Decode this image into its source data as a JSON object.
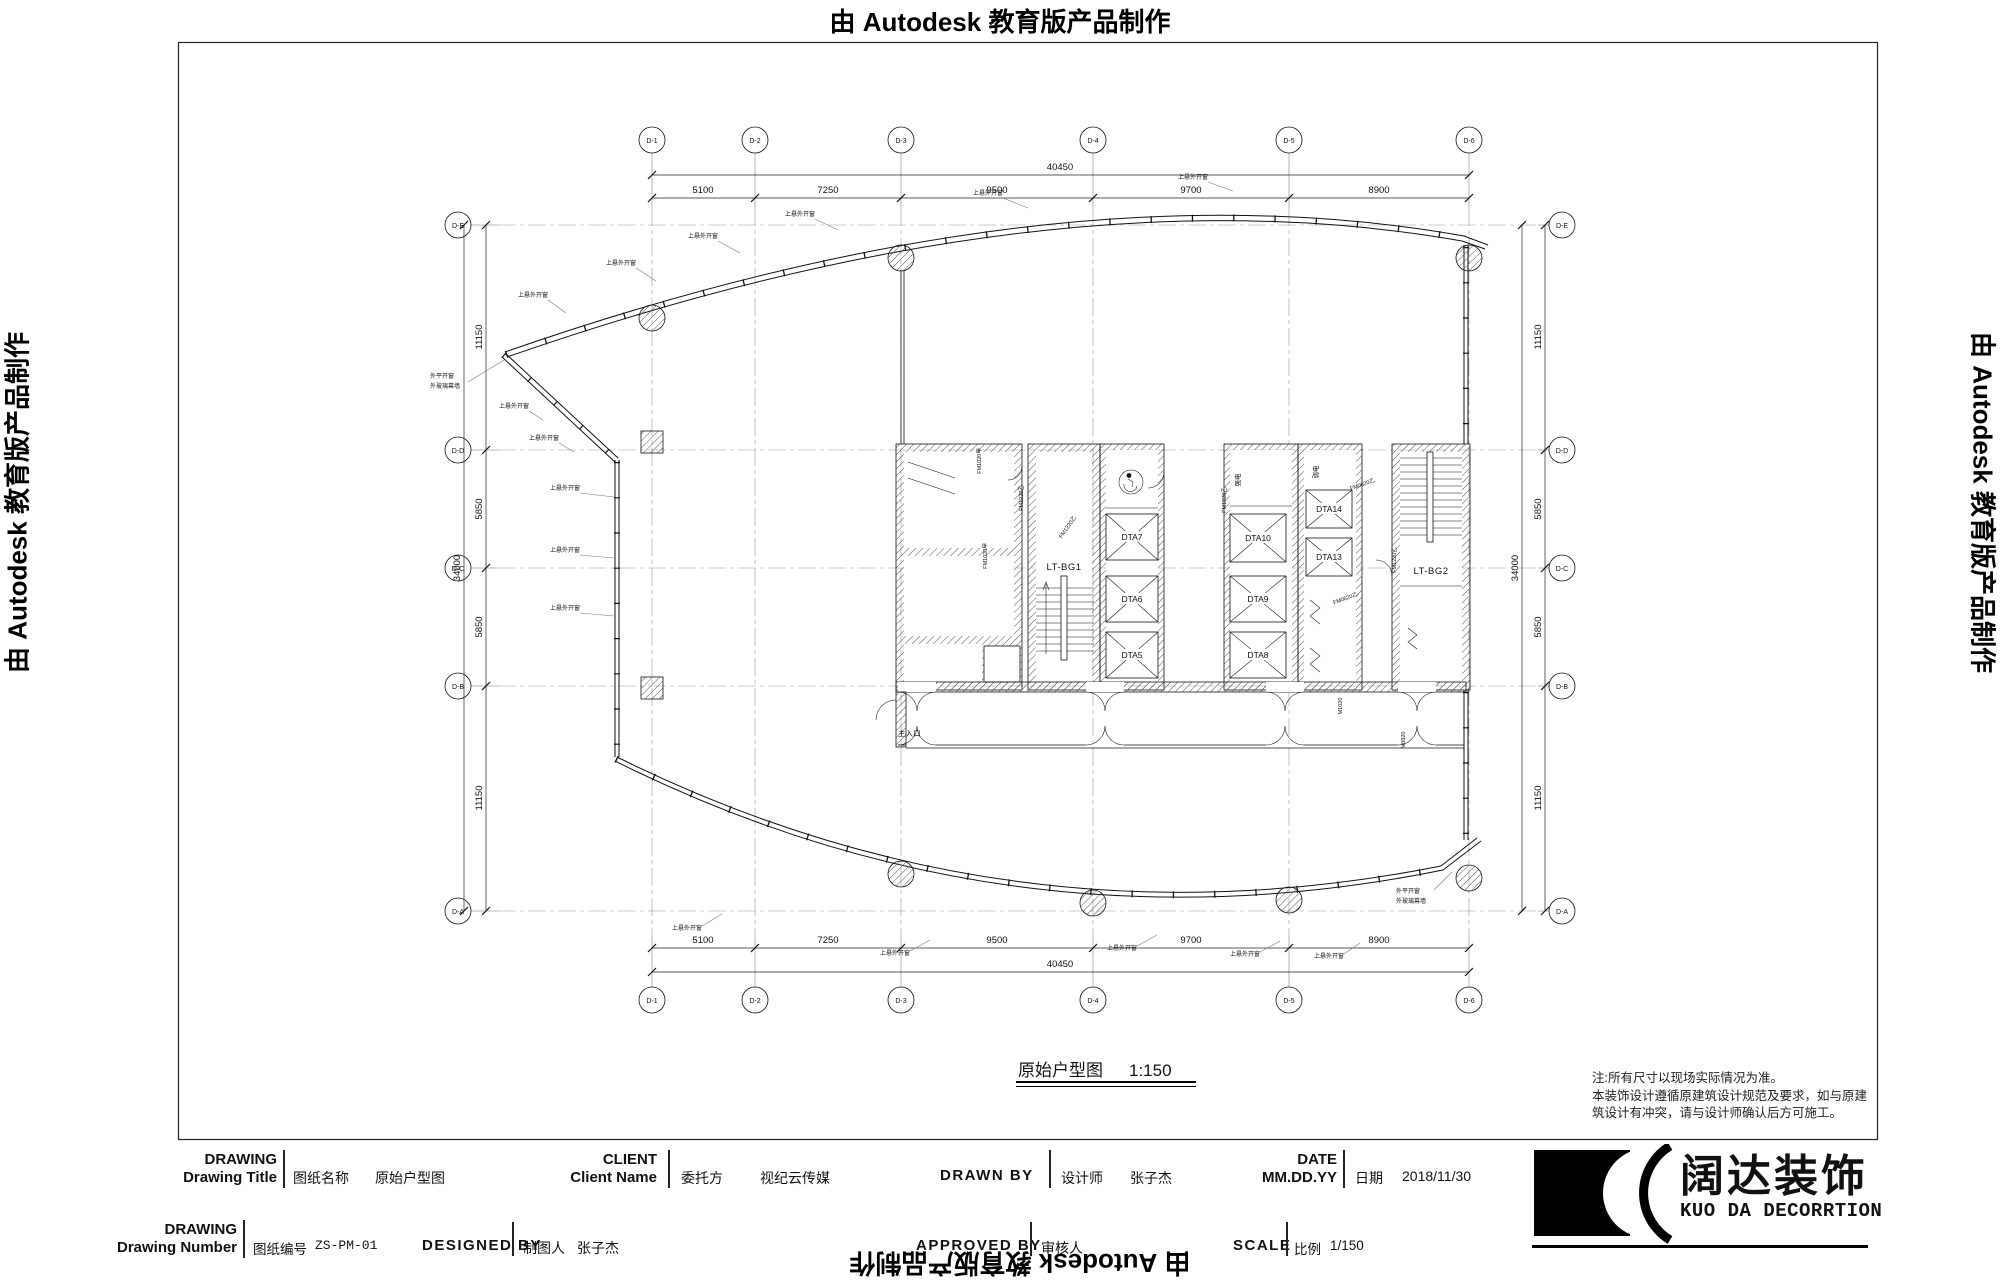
{
  "watermark": {
    "text": "由 Autodesk 教育版产品制作"
  },
  "grid": {
    "cols": [
      "D-1",
      "D-2",
      "D-3",
      "D-4",
      "D-5",
      "D-6"
    ],
    "rows": [
      "D-E",
      "D-D",
      "D-C",
      "D-B",
      "D-A"
    ],
    "top_dims": [
      "5100",
      "7250",
      "9500",
      "9700",
      "8900"
    ],
    "top_total": "40450",
    "bottom_dims": [
      "5100",
      "7250",
      "9500",
      "9700",
      "8900"
    ],
    "bottom_total": "40450",
    "left_dims": [
      "11150",
      "5850",
      "5850",
      "11150"
    ],
    "left_total": "34000",
    "right_dims": [
      "11150",
      "5850",
      "5850",
      "11150"
    ],
    "right_total": "34000"
  },
  "plan": {
    "stair1": "LT-BG1",
    "stair2": "LT-BG2",
    "elevators": [
      "DTA7",
      "DTA6",
      "DTA5",
      "DTA10",
      "DTA9",
      "DTA8",
      "DTA14",
      "DTA13"
    ],
    "room_strong_power": "强电",
    "room_weak_power": "弱电",
    "entrance": "主入口",
    "window_label": "上悬外开窗",
    "vertex_label_1": "外平开窗",
    "vertex_label_2": "外玻璃幕墙",
    "door_tags": [
      "FM1020甲",
      "FM1220乙",
      "FM1020乙",
      "FM0620乙",
      "M1020",
      "M0820"
    ]
  },
  "title": {
    "text": "原始户型图",
    "scale": "1:150"
  },
  "notes": {
    "line1": "注:所有尺寸以现场实际情况为准。",
    "line2": "本装饰设计遵循原建筑设计规范及要求，如与原建",
    "line3": "筑设计有冲突，请与设计师确认后方可施工。"
  },
  "titleblock": {
    "drawing_title": {
      "en1": "DRAWING",
      "en2": "Drawing Title",
      "zh": "图纸名称",
      "value": "原始户型图"
    },
    "client": {
      "en1": "CLIENT",
      "en2": "Client Name",
      "zh": "委托方",
      "value": "视纪云传媒"
    },
    "drawn_by": {
      "en1": "DRAWN BY",
      "zh": "设计师",
      "value": "张子杰"
    },
    "date": {
      "en1": "DATE",
      "en2": "MM.DD.YY",
      "zh": "日期",
      "value": "2018/11/30"
    },
    "drawing_number": {
      "en1": "DRAWING",
      "en2": "Drawing Number",
      "zh": "图纸编号",
      "value": "ZS-PM-01"
    },
    "designed_by": {
      "en1": "DESIGNED BY",
      "zh": "制图人",
      "value": "张子杰"
    },
    "approved_by": {
      "en1": "APPROVED BY",
      "zh": "审核人",
      "value": ""
    },
    "scale": {
      "en1": "SCALE",
      "zh": "比例",
      "value": "1/150"
    }
  },
  "logo": {
    "zh": "阔达装饰",
    "en": "KUO DA DECORRTION"
  }
}
